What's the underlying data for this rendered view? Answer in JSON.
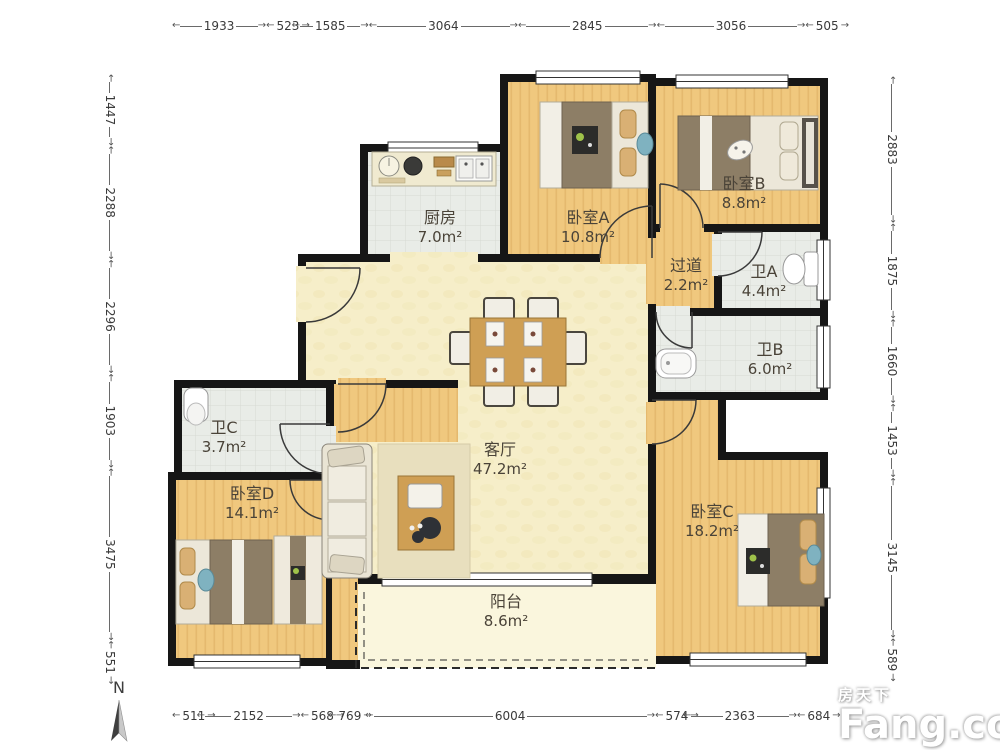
{
  "north": {
    "label": "N"
  },
  "watermark": {
    "brand_cn": "房天下",
    "brand_en": "Fang.com"
  },
  "dims": {
    "top": [
      "1933",
      "523",
      "1585",
      "3064",
      "2845",
      "3056",
      "505"
    ],
    "left": [
      "1447",
      "2288",
      "2296",
      "1903",
      "3475",
      "551"
    ],
    "right": [
      "2883",
      "1875",
      "1660",
      "1453",
      "3145",
      "589"
    ],
    "bottom": [
      "511",
      "2152",
      "568",
      "769",
      "6004",
      "574",
      "2363",
      "684"
    ]
  },
  "rooms": {
    "kitchen": {
      "name": "厨房",
      "area": "7.0m²"
    },
    "bedroomA": {
      "name": "卧室A",
      "area": "10.8m²"
    },
    "bedroomB": {
      "name": "卧室B",
      "area": "8.8m²"
    },
    "hallway": {
      "name": "过道",
      "area": "2.2m²"
    },
    "bathA": {
      "name": "卫A",
      "area": "4.4m²"
    },
    "bathB": {
      "name": "卫B",
      "area": "6.0m²"
    },
    "bathC": {
      "name": "卫C",
      "area": "3.7m²"
    },
    "bedroomD": {
      "name": "卧室D",
      "area": "14.1m²"
    },
    "living": {
      "name": "客厅",
      "area": "47.2m²"
    },
    "bedroomC": {
      "name": "卧室C",
      "area": "18.2m²"
    },
    "balcony": {
      "name": "阳台",
      "area": "8.6m²"
    }
  }
}
